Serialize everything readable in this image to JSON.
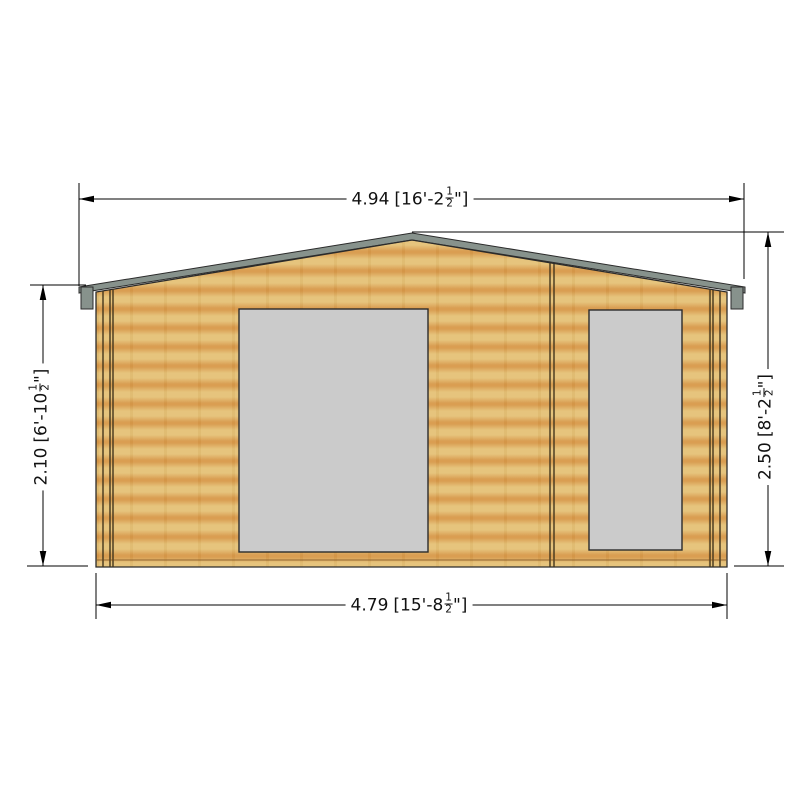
{
  "drawing": {
    "subject": "garden-log-cabin-front-elevation"
  },
  "dimensions": {
    "top": {
      "metric": "4.94",
      "imperial_open": "[16'-2",
      "frac_num": "1",
      "frac_den": "2",
      "imperial_close": "\"]"
    },
    "bottom": {
      "metric": "4.79",
      "imperial_open": "[15'-8",
      "frac_num": "1",
      "frac_den": "2",
      "imperial_close": "\"]"
    },
    "left": {
      "metric": "2.10",
      "imperial_open": "[6'-10",
      "frac_num": "1",
      "frac_den": "2",
      "imperial_close": "\"]"
    },
    "right": {
      "metric": "2.50",
      "imperial_open": "[8'-2",
      "frac_num": "1",
      "frac_den": "2",
      "imperial_close": "\"]"
    }
  },
  "colors": {
    "background": "#ffffff",
    "wood_light": "#e5c278",
    "wood_mid": "#dfae62",
    "wood_dark": "#d89a4b",
    "roof_gray": "#87928c",
    "window_gray": "#cbcbcb",
    "outline": "#2b2b2b",
    "trim_line": "#43351c",
    "dim_line": "#000000"
  }
}
